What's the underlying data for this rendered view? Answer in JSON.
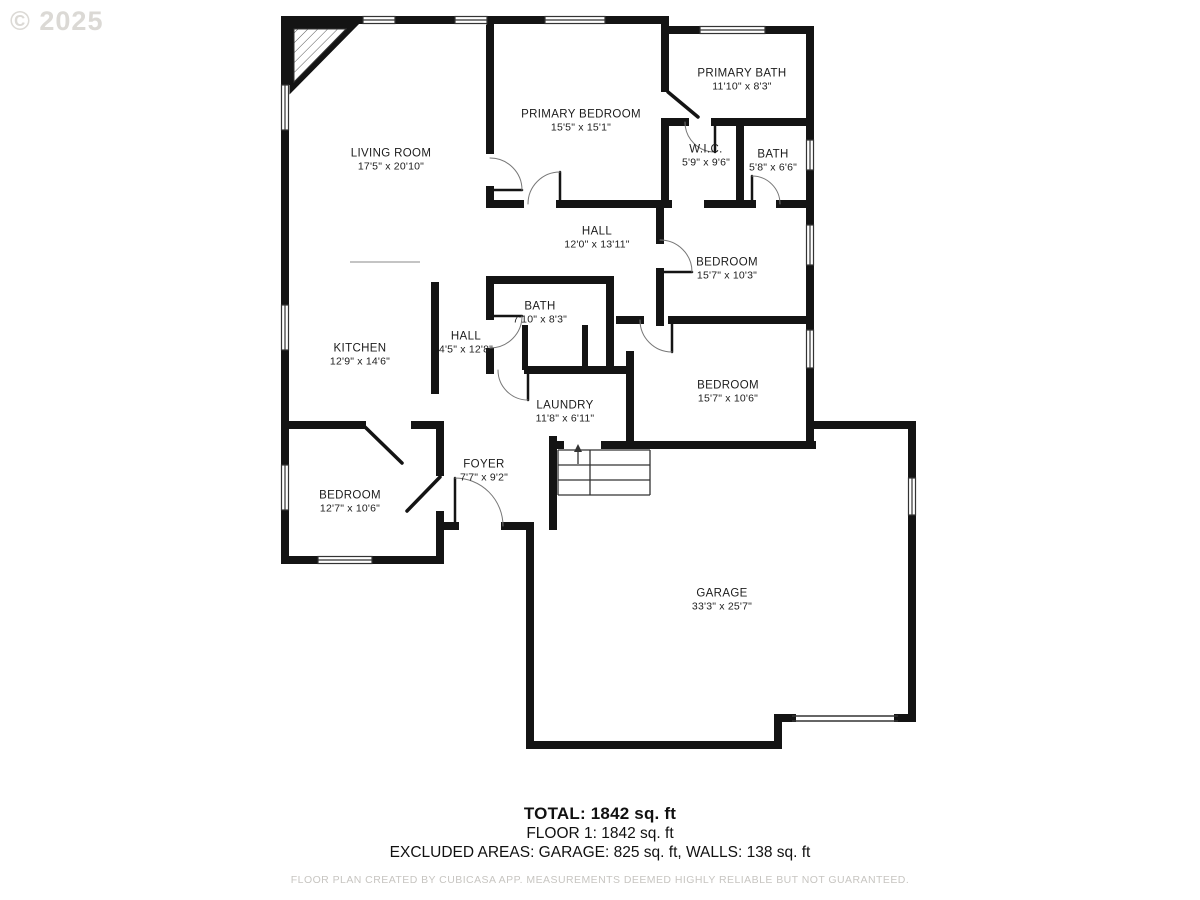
{
  "watermark": "© 2025",
  "rooms": [
    {
      "id": "living-room",
      "name": "LIVING ROOM",
      "dims": "17'5\" x 20'10\""
    },
    {
      "id": "primary-bedroom",
      "name": "PRIMARY BEDROOM",
      "dims": "15'5\" x 15'1\""
    },
    {
      "id": "primary-bath",
      "name": "PRIMARY BATH",
      "dims": "11'10\" x 8'3\""
    },
    {
      "id": "wic",
      "name": "W.I.C.",
      "dims": "5'9\" x 9'6\""
    },
    {
      "id": "bath-small",
      "name": "BATH",
      "dims": "5'8\" x 6'6\""
    },
    {
      "id": "hall-main",
      "name": "HALL",
      "dims": "12'0\" x 13'11\""
    },
    {
      "id": "bedroom-1",
      "name": "BEDROOM",
      "dims": "15'7\" x 10'3\""
    },
    {
      "id": "bath-center",
      "name": "BATH",
      "dims": "7'10\" x 8'3\""
    },
    {
      "id": "hall-2",
      "name": "HALL",
      "dims": "4'5\" x 12'8\""
    },
    {
      "id": "kitchen",
      "name": "KITCHEN",
      "dims": "12'9\" x 14'6\""
    },
    {
      "id": "laundry",
      "name": "LAUNDRY",
      "dims": "11'8\" x 6'11\""
    },
    {
      "id": "bedroom-2",
      "name": "BEDROOM",
      "dims": "15'7\" x 10'6\""
    },
    {
      "id": "foyer",
      "name": "FOYER",
      "dims": "7'7\" x 9'2\""
    },
    {
      "id": "bedroom-3",
      "name": "BEDROOM",
      "dims": "12'7\" x 10'6\""
    },
    {
      "id": "garage",
      "name": "GARAGE",
      "dims": "33'3\" x 25'7\""
    }
  ],
  "summary": {
    "total": "TOTAL: 1842 sq. ft",
    "floor1": "FLOOR 1: 1842 sq. ft",
    "excluded": "EXCLUDED AREAS: GARAGE: 825 sq. ft, WALLS: 138 sq. ft",
    "disclaimer": "FLOOR PLAN CREATED BY CUBICASA APP. MEASUREMENTS DEEMED HIGHLY RELIABLE BUT NOT GUARANTEED."
  },
  "colors": {
    "wall": "#141414",
    "thin_line": "#333333",
    "watermark": "#dbd9d5",
    "text": "#1c1c1c",
    "disclaimer": "#c7c5c1"
  }
}
